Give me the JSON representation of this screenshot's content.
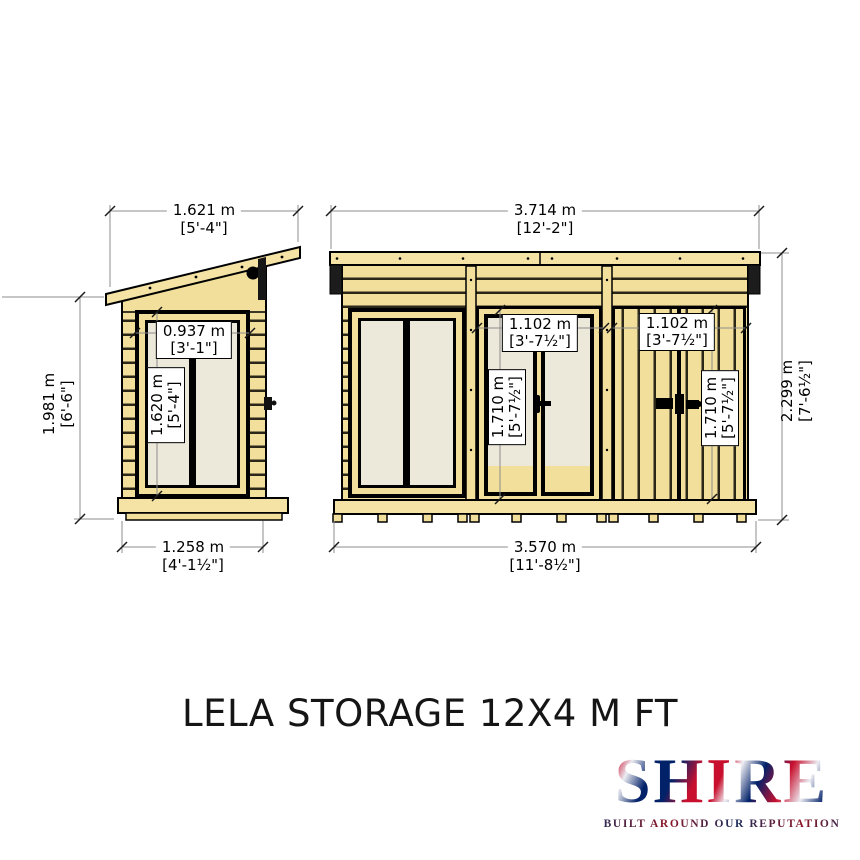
{
  "page": {
    "title": "LELA STORAGE 12X4 M FT"
  },
  "logo": {
    "name": "SHIRE",
    "tagline": "BUILT AROUND OUR REPUTATION",
    "flag_red": "#C8102E",
    "flag_blue": "#012169"
  },
  "colors": {
    "wood": "#F2DF9C",
    "wood_light": "#F5E3A6",
    "board_gap": "#2B2718",
    "glazing": "#ECE8DA",
    "outline": "#000000",
    "dim_line": "#8C8C8C"
  },
  "drawing": {
    "side": {
      "width": {
        "m": "1.621 m",
        "ft": "[5'-4\"]"
      },
      "height": {
        "m": "1.981 m",
        "ft": "[6'-6\"]"
      },
      "window_width": {
        "m": "0.937 m",
        "ft": "[3'-1\"]"
      },
      "window_height": {
        "m": "1.620 m",
        "ft": "[5'-4\"]"
      },
      "base": {
        "m": "1.258 m",
        "ft": "[4'-1½\"]"
      }
    },
    "front": {
      "width": {
        "m": "3.714 m",
        "ft": "[12'-2\"]"
      },
      "height": {
        "m": "2.299 m",
        "ft": "[7'-6½\"]"
      },
      "mid_door_width": {
        "m": "1.102 m",
        "ft": "[3'-7½\"]"
      },
      "mid_door_height": {
        "m": "1.710 m",
        "ft": "[5'-7½\"]"
      },
      "right_door_width": {
        "m": "1.102 m",
        "ft": "[3'-7½\"]"
      },
      "right_door_height": {
        "m": "1.710 m",
        "ft": "[5'-7½\"]"
      },
      "base": {
        "m": "3.570 m",
        "ft": "[11'-8½\"]"
      }
    }
  }
}
